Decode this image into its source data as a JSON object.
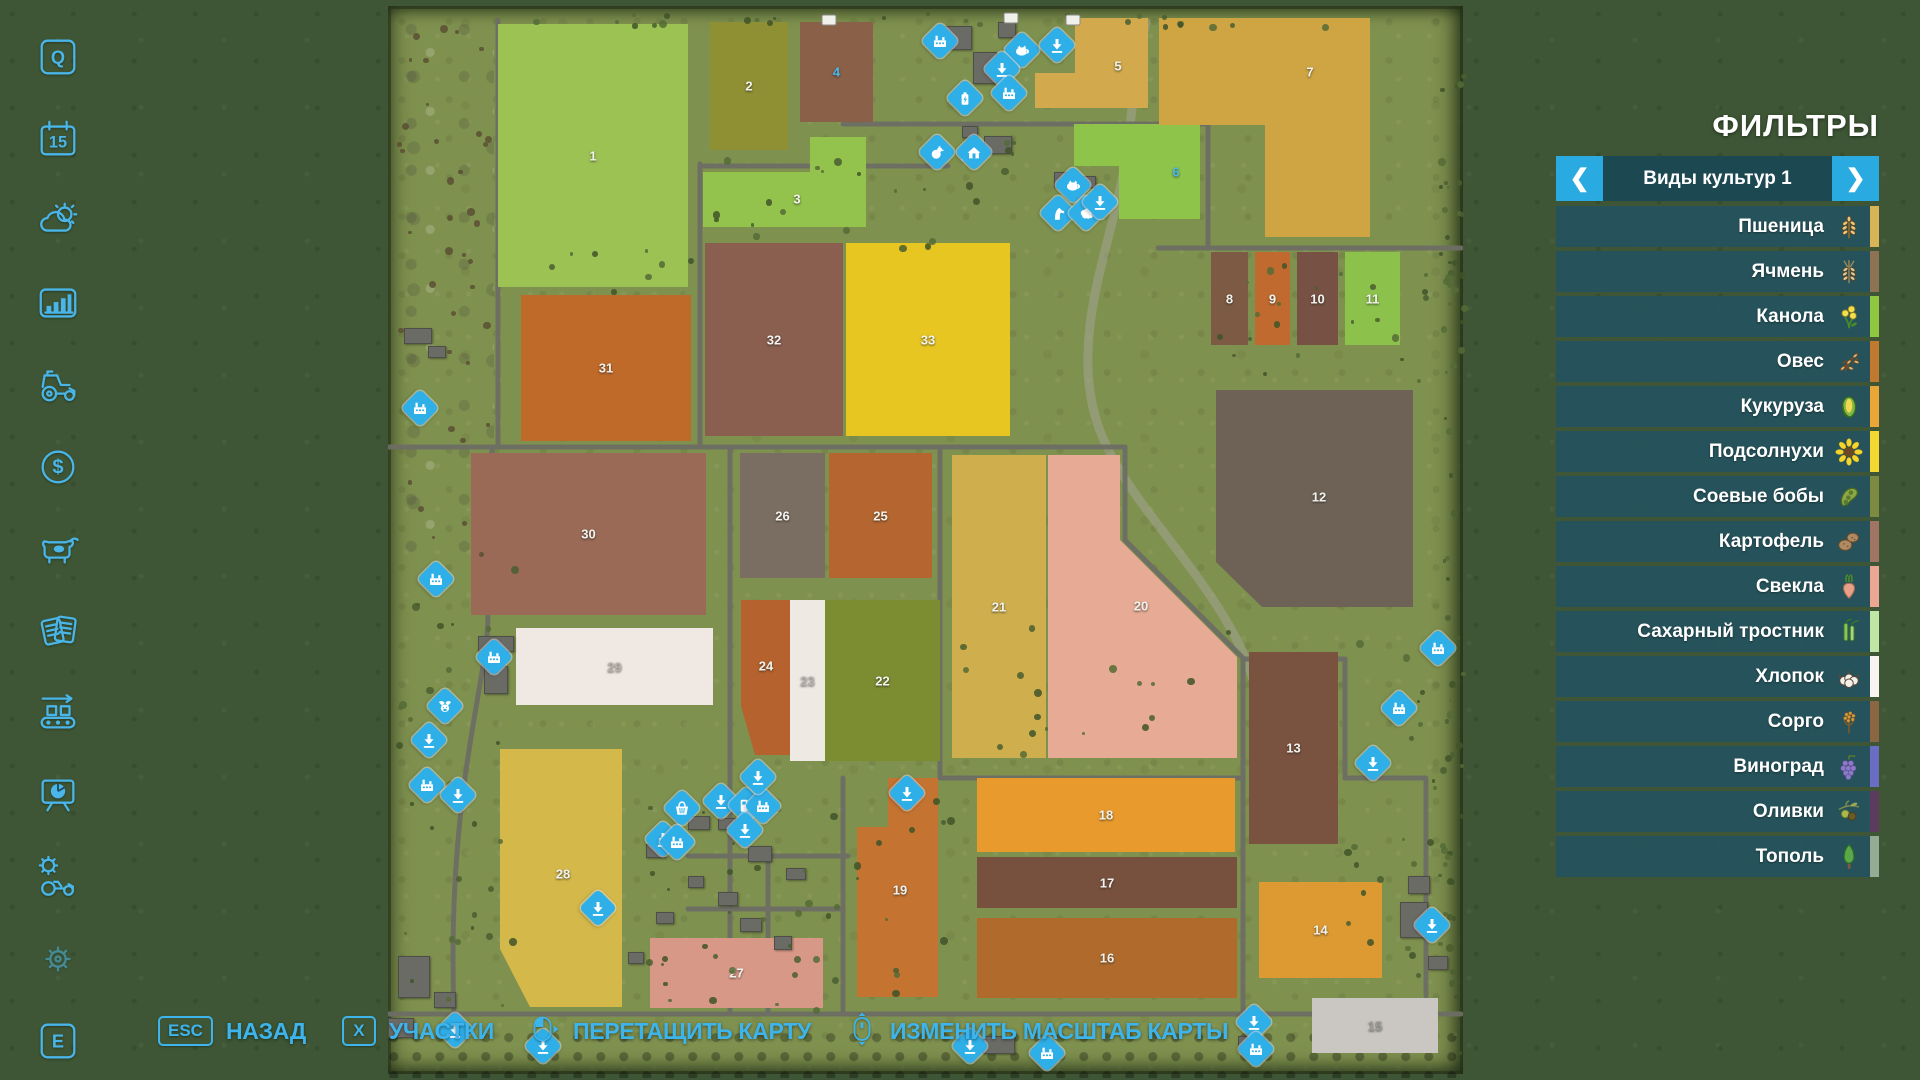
{
  "colors": {
    "accent": "#3db5ec",
    "marker_blue": "#2fafe8",
    "panel_teal": "#25535e",
    "map_grass": "#7f914f"
  },
  "sidebar": {
    "items": [
      {
        "icon": "key-q",
        "label": "Q"
      },
      {
        "icon": "calendar",
        "label": "15"
      },
      {
        "icon": "weather",
        "label": ""
      },
      {
        "icon": "stats",
        "label": ""
      },
      {
        "icon": "vehicles",
        "label": ""
      },
      {
        "icon": "finances",
        "label": ""
      },
      {
        "icon": "animals",
        "label": ""
      },
      {
        "icon": "contracts",
        "label": ""
      },
      {
        "icon": "production",
        "label": ""
      },
      {
        "icon": "presentation",
        "label": ""
      },
      {
        "icon": "garage",
        "label": ""
      },
      {
        "icon": "settings",
        "label": ""
      },
      {
        "icon": "key-e",
        "label": "E"
      }
    ]
  },
  "filters": {
    "title": "ФИЛЬТРЫ",
    "category": "Виды культур 1",
    "prev_label": "❮",
    "next_label": "❯",
    "crops": [
      {
        "label": "Пшеница",
        "icon": "wheat",
        "stripe": "#d9b457"
      },
      {
        "label": "Ячмень",
        "icon": "barley",
        "stripe": "#8d7354"
      },
      {
        "label": "Канола",
        "icon": "canola",
        "stripe": "#8fc83e"
      },
      {
        "label": "Овес",
        "icon": "oat",
        "stripe": "#c1792f"
      },
      {
        "label": "Кукуруза",
        "icon": "corn",
        "stripe": "#eaa636"
      },
      {
        "label": "Подсолнухи",
        "icon": "sunflower",
        "stripe": "#f6d832"
      },
      {
        "label": "Соевые бобы",
        "icon": "soybean",
        "stripe": "#7d8b42"
      },
      {
        "label": "Картофель",
        "icon": "potato",
        "stripe": "#a17463"
      },
      {
        "label": "Свекла",
        "icon": "beet",
        "stripe": "#eba793"
      },
      {
        "label": "Сахарный тростник",
        "icon": "sugarcane",
        "stripe": "#bfe6a4"
      },
      {
        "label": "Хлопок",
        "icon": "cotton",
        "stripe": "#f7f3ee"
      },
      {
        "label": "Сорго",
        "icon": "sorghum",
        "stripe": "#8a6742"
      },
      {
        "label": "Виноград",
        "icon": "grape",
        "stripe": "#6b6cc4"
      },
      {
        "label": "Оливки",
        "icon": "olive",
        "stripe": "#5d3b5e"
      },
      {
        "label": "Тополь",
        "icon": "poplar",
        "stripe": "#93ac93"
      }
    ]
  },
  "bottom_bar": {
    "items": [
      {
        "key": "ESC",
        "label": "НАЗАД"
      },
      {
        "key": "X",
        "label": "УЧАСТКИ"
      },
      {
        "mouse": "mouse-drag",
        "label": "ПЕРЕТАЩИТЬ КАРТУ"
      },
      {
        "mouse": "mouse-scroll",
        "label": "ИЗМЕНИТЬ МАСШТАБ КАРТЫ"
      }
    ]
  },
  "map": {
    "fields": [
      {
        "id": "1",
        "color": "#9cc253",
        "pts": [
          [
            110,
            18
          ],
          [
            300,
            18
          ],
          [
            300,
            281
          ],
          [
            110,
            281
          ]
        ]
      },
      {
        "id": "2",
        "color": "#8f8f33",
        "pts": [
          [
            322,
            16
          ],
          [
            400,
            16
          ],
          [
            400,
            144
          ],
          [
            322,
            144
          ]
        ]
      },
      {
        "id": "3",
        "color": "#93c24d",
        "pts": [
          [
            315,
            166
          ],
          [
            422,
            166
          ],
          [
            422,
            131
          ],
          [
            478,
            131
          ],
          [
            478,
            221
          ],
          [
            315,
            221
          ]
        ],
        "lp": [
          409,
          193
        ]
      },
      {
        "id": "4",
        "color": "#8a6049",
        "label_color": "#4ab8ea",
        "pts": [
          [
            412,
            16
          ],
          [
            485,
            16
          ],
          [
            485,
            116
          ],
          [
            412,
            116
          ]
        ]
      },
      {
        "id": "5",
        "color": "#d2a94c",
        "pts": [
          [
            647,
            67
          ],
          [
            687,
            67
          ],
          [
            687,
            12
          ],
          [
            760,
            12
          ],
          [
            760,
            102
          ],
          [
            647,
            102
          ]
        ],
        "lp": [
          730,
          60
        ]
      },
      {
        "id": "6",
        "color": "#8ec449",
        "label_color": "#4ab8ea",
        "pts": [
          [
            686,
            118
          ],
          [
            812,
            118
          ],
          [
            812,
            213
          ],
          [
            731,
            213
          ],
          [
            731,
            160
          ],
          [
            686,
            160
          ]
        ],
        "lp": [
          788,
          166
        ]
      },
      {
        "id": "7",
        "color": "#cfa443",
        "pts": [
          [
            771,
            12
          ],
          [
            982,
            12
          ],
          [
            982,
            231
          ],
          [
            877,
            231
          ],
          [
            877,
            119
          ],
          [
            771,
            119
          ]
        ],
        "lp": [
          922,
          66
        ]
      },
      {
        "id": "8",
        "color": "#7d5a44",
        "pts": [
          [
            823,
            246
          ],
          [
            860,
            246
          ],
          [
            860,
            339
          ],
          [
            823,
            339
          ]
        ]
      },
      {
        "id": "9",
        "color": "#c06a2f",
        "pts": [
          [
            867,
            246
          ],
          [
            902,
            246
          ],
          [
            902,
            339
          ],
          [
            867,
            339
          ]
        ]
      },
      {
        "id": "10",
        "color": "#775144",
        "pts": [
          [
            909,
            246
          ],
          [
            950,
            246
          ],
          [
            950,
            339
          ],
          [
            909,
            339
          ]
        ]
      },
      {
        "id": "11",
        "color": "#8cc24b",
        "pts": [
          [
            957,
            246
          ],
          [
            1012,
            246
          ],
          [
            1012,
            339
          ],
          [
            957,
            339
          ]
        ]
      },
      {
        "id": "12",
        "color": "#6e6257",
        "pts": [
          [
            828,
            384
          ],
          [
            1025,
            384
          ],
          [
            1025,
            601
          ],
          [
            874,
            601
          ],
          [
            828,
            556
          ]
        ],
        "lp": [
          931,
          491
        ]
      },
      {
        "id": "13",
        "color": "#7a5240",
        "pts": [
          [
            861,
            646
          ],
          [
            950,
            646
          ],
          [
            950,
            838
          ],
          [
            861,
            838
          ]
        ]
      },
      {
        "id": "14",
        "color": "#dd9a33",
        "pts": [
          [
            871,
            876
          ],
          [
            994,
            876
          ],
          [
            994,
            972
          ],
          [
            871,
            972
          ]
        ]
      },
      {
        "id": "15",
        "color": "#cac6c1",
        "label_color": "#9b9b97",
        "pts": [
          [
            924,
            992
          ],
          [
            1050,
            992
          ],
          [
            1050,
            1047
          ],
          [
            924,
            1047
          ]
        ]
      },
      {
        "id": "16",
        "color": "#b06b2c",
        "pts": [
          [
            589,
            912
          ],
          [
            849,
            912
          ],
          [
            849,
            992
          ],
          [
            589,
            992
          ]
        ]
      },
      {
        "id": "17",
        "color": "#77503e",
        "pts": [
          [
            589,
            851
          ],
          [
            849,
            851
          ],
          [
            849,
            902
          ],
          [
            589,
            902
          ]
        ]
      },
      {
        "id": "18",
        "color": "#e89a2d",
        "pts": [
          [
            589,
            772
          ],
          [
            847,
            772
          ],
          [
            847,
            846
          ],
          [
            589,
            846
          ]
        ]
      },
      {
        "id": "19",
        "color": "#c47331",
        "pts": [
          [
            500,
            772
          ],
          [
            550,
            772
          ],
          [
            550,
            991
          ],
          [
            469,
            991
          ],
          [
            469,
            821
          ],
          [
            500,
            821
          ]
        ],
        "lp": [
          512,
          884
        ]
      },
      {
        "id": "20",
        "color": "#e7ab95",
        "pts": [
          [
            660,
            449
          ],
          [
            732,
            449
          ],
          [
            732,
            534
          ],
          [
            849,
            651
          ],
          [
            849,
            752
          ],
          [
            660,
            752
          ]
        ],
        "lp": [
          753,
          600
        ]
      },
      {
        "id": "21",
        "color": "#cfae4e",
        "pts": [
          [
            564,
            449
          ],
          [
            658,
            449
          ],
          [
            658,
            752
          ],
          [
            564,
            752
          ]
        ]
      },
      {
        "id": "22",
        "color": "#7c8c30",
        "pts": [
          [
            437,
            594
          ],
          [
            552,
            594
          ],
          [
            552,
            755
          ],
          [
            437,
            755
          ]
        ]
      },
      {
        "id": "23",
        "color": "#efe9e4",
        "label_color": "#b9b3ae",
        "pts": [
          [
            402,
            594
          ],
          [
            437,
            594
          ],
          [
            437,
            755
          ],
          [
            402,
            755
          ]
        ]
      },
      {
        "id": "24",
        "color": "#b5622e",
        "pts": [
          [
            353,
            594
          ],
          [
            402,
            594
          ],
          [
            402,
            749
          ],
          [
            367,
            749
          ],
          [
            353,
            700
          ]
        ],
        "lp": [
          378,
          660
        ]
      },
      {
        "id": "25",
        "color": "#b5652f",
        "pts": [
          [
            441,
            447
          ],
          [
            544,
            447
          ],
          [
            544,
            572
          ],
          [
            441,
            572
          ]
        ]
      },
      {
        "id": "26",
        "color": "#7a6e62",
        "pts": [
          [
            352,
            447
          ],
          [
            437,
            447
          ],
          [
            437,
            572
          ],
          [
            352,
            572
          ]
        ]
      },
      {
        "id": "27",
        "color": "#d89888",
        "pts": [
          [
            262,
            932
          ],
          [
            435,
            932
          ],
          [
            435,
            1002
          ],
          [
            262,
            1002
          ]
        ]
      },
      {
        "id": "28",
        "color": "#d4b84a",
        "pts": [
          [
            112,
            743
          ],
          [
            234,
            743
          ],
          [
            234,
            1001
          ],
          [
            142,
            1001
          ],
          [
            112,
            943
          ]
        ],
        "lp": [
          175,
          868
        ]
      },
      {
        "id": "29",
        "color": "#f0e8e2",
        "label_color": "#b9b3ae",
        "pts": [
          [
            128,
            622
          ],
          [
            325,
            622
          ],
          [
            325,
            699
          ],
          [
            128,
            699
          ]
        ]
      },
      {
        "id": "30",
        "color": "#9a6a56",
        "pts": [
          [
            83,
            447
          ],
          [
            318,
            447
          ],
          [
            318,
            609
          ],
          [
            83,
            609
          ]
        ]
      },
      {
        "id": "31",
        "color": "#c06a2a",
        "pts": [
          [
            133,
            289
          ],
          [
            303,
            289
          ],
          [
            303,
            435
          ],
          [
            133,
            435
          ]
        ]
      },
      {
        "id": "32",
        "color": "#8a5f50",
        "pts": [
          [
            317,
            237
          ],
          [
            455,
            237
          ],
          [
            455,
            430
          ],
          [
            317,
            430
          ]
        ]
      },
      {
        "id": "33",
        "color": "#e8c622",
        "pts": [
          [
            458,
            237
          ],
          [
            622,
            237
          ],
          [
            622,
            430
          ],
          [
            458,
            430
          ]
        ]
      }
    ],
    "markers": [
      {
        "x": 552,
        "y": 35,
        "icon": "factory"
      },
      {
        "x": 634,
        "y": 44,
        "icon": "pig"
      },
      {
        "x": 669,
        "y": 39,
        "icon": "down"
      },
      {
        "x": 614,
        "y": 63,
        "icon": "down"
      },
      {
        "x": 621,
        "y": 87,
        "icon": "factory"
      },
      {
        "x": 577,
        "y": 92,
        "icon": "battery"
      },
      {
        "x": 549,
        "y": 146,
        "icon": "chicken"
      },
      {
        "x": 586,
        "y": 146,
        "icon": "home"
      },
      {
        "x": 685,
        "y": 179,
        "icon": "pig"
      },
      {
        "x": 670,
        "y": 207,
        "icon": "horse"
      },
      {
        "x": 698,
        "y": 207,
        "icon": "sheep"
      },
      {
        "x": 712,
        "y": 196,
        "icon": "down"
      },
      {
        "x": 32,
        "y": 402,
        "icon": "factory"
      },
      {
        "x": 48,
        "y": 573,
        "icon": "factory"
      },
      {
        "x": 106,
        "y": 651,
        "icon": "factory"
      },
      {
        "x": 57,
        "y": 700,
        "icon": "bull"
      },
      {
        "x": 41,
        "y": 734,
        "icon": "down"
      },
      {
        "x": 39,
        "y": 779,
        "icon": "factory"
      },
      {
        "x": 70,
        "y": 789,
        "icon": "down"
      },
      {
        "x": 294,
        "y": 802,
        "icon": "basket"
      },
      {
        "x": 333,
        "y": 795,
        "icon": "down"
      },
      {
        "x": 358,
        "y": 799,
        "icon": "fuel"
      },
      {
        "x": 375,
        "y": 800,
        "icon": "factory"
      },
      {
        "x": 357,
        "y": 824,
        "icon": "down"
      },
      {
        "x": 275,
        "y": 833,
        "icon": "down"
      },
      {
        "x": 289,
        "y": 836,
        "icon": "factory"
      },
      {
        "x": 210,
        "y": 902,
        "icon": "down"
      },
      {
        "x": 370,
        "y": 771,
        "icon": "down"
      },
      {
        "x": 519,
        "y": 787,
        "icon": "down"
      },
      {
        "x": 1050,
        "y": 642,
        "icon": "factory"
      },
      {
        "x": 1011,
        "y": 702,
        "icon": "factory"
      },
      {
        "x": 985,
        "y": 757,
        "icon": "down"
      },
      {
        "x": 1044,
        "y": 919,
        "icon": "down"
      },
      {
        "x": 866,
        "y": 1016,
        "icon": "down"
      },
      {
        "x": 868,
        "y": 1043,
        "icon": "factory"
      },
      {
        "x": 659,
        "y": 1047,
        "icon": "factory"
      },
      {
        "x": 582,
        "y": 1040,
        "icon": "down"
      },
      {
        "x": 67,
        "y": 1024,
        "icon": "down"
      },
      {
        "x": 155,
        "y": 1040,
        "icon": "down"
      }
    ],
    "vehicles": [
      [
        441,
        6
      ],
      [
        623,
        4
      ],
      [
        685,
        6
      ],
      [
        580,
        142
      ]
    ]
  }
}
